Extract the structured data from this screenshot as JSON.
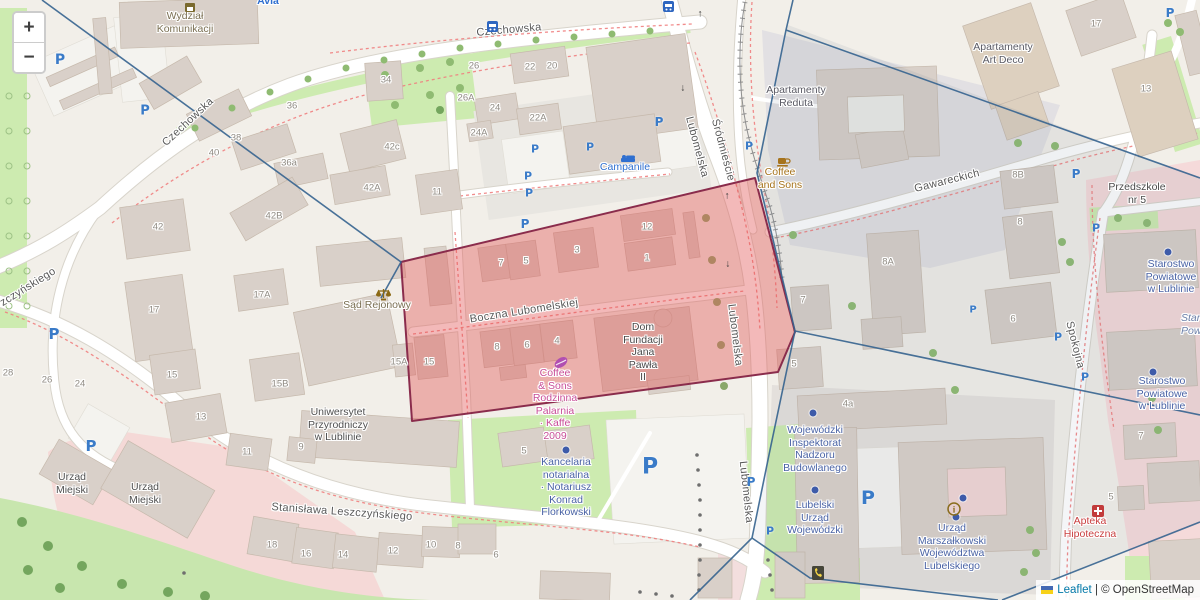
{
  "controls": {
    "zoom_in": "+",
    "zoom_out": "−"
  },
  "attribution": {
    "flag": "ukraine-flag-icon",
    "leaflet": "Leaflet",
    "separator": " | ",
    "osm": "© OpenStreetMap"
  },
  "colors": {
    "street": "#595959",
    "number": "#8f8a82",
    "place": "#5a5a64",
    "place_dark": "#4a4a4a",
    "gov": "#4a63a5",
    "amenity": "#7a6f52",
    "cafe": "#a6731c",
    "shop_pink": "#c84d97",
    "hotel_blue": "#2f6fd0",
    "pharmacy_red": "#c94040",
    "uni_gray": "#4f4f4f",
    "italic_blue": "#6b7fa8",
    "parking_blue": "#3a7bc8",
    "red_overlay_border": "#8a2c4c",
    "blue_boundary": "#35638f"
  },
  "labels": {
    "streets": [
      {
        "text": "Czechowska",
        "x": 188,
        "y": 122,
        "rot": -43
      },
      {
        "text": "Czechowska",
        "x": 509,
        "y": 30,
        "rot": -5
      },
      {
        "text": "Lubomelska",
        "x": 697,
        "y": 147,
        "rot": 75
      },
      {
        "text": "Śródmieście",
        "x": 723,
        "y": 150,
        "rot": 75
      },
      {
        "text": "Lubomelska",
        "x": 735,
        "y": 335,
        "rot": 83
      },
      {
        "text": "Lubomelska",
        "x": 746,
        "y": 492,
        "rot": 84
      },
      {
        "text": "Boczna Lubomelskiej",
        "x": 524,
        "y": 311,
        "rot": -9
      },
      {
        "text": "Stanisława Leszczyńskiego",
        "x": 342,
        "y": 512,
        "rot": 4
      },
      {
        "text": "zczyńskiego",
        "x": 28,
        "y": 287,
        "rot": -32
      },
      {
        "text": "Spokojna",
        "x": 1075,
        "y": 345,
        "rot": 76
      },
      {
        "text": "Gawareckich",
        "x": 947,
        "y": 181,
        "rot": -14
      }
    ],
    "house_numbers": [
      {
        "text": "34",
        "x": 386,
        "y": 80
      },
      {
        "text": "26",
        "x": 474,
        "y": 66
      },
      {
        "text": "22",
        "x": 530,
        "y": 67
      },
      {
        "text": "20",
        "x": 552,
        "y": 66
      },
      {
        "text": "26A",
        "x": 466,
        "y": 98
      },
      {
        "text": "24",
        "x": 495,
        "y": 108
      },
      {
        "text": "22A",
        "x": 538,
        "y": 118
      },
      {
        "text": "24A",
        "x": 479,
        "y": 133
      },
      {
        "text": "42c",
        "x": 392,
        "y": 147
      },
      {
        "text": "42A",
        "x": 372,
        "y": 188
      },
      {
        "text": "11",
        "x": 437,
        "y": 192
      },
      {
        "text": "36",
        "x": 292,
        "y": 106
      },
      {
        "text": "36a",
        "x": 289,
        "y": 163
      },
      {
        "text": "38",
        "x": 236,
        "y": 138
      },
      {
        "text": "40",
        "x": 214,
        "y": 153
      },
      {
        "text": "42",
        "x": 158,
        "y": 227
      },
      {
        "text": "42B",
        "x": 274,
        "y": 216
      },
      {
        "text": "17A",
        "x": 262,
        "y": 295
      },
      {
        "text": "17",
        "x": 154,
        "y": 310
      },
      {
        "text": "15",
        "x": 172,
        "y": 375
      },
      {
        "text": "13",
        "x": 201,
        "y": 417
      },
      {
        "text": "15B",
        "x": 280,
        "y": 384
      },
      {
        "text": "28",
        "x": 8,
        "y": 373
      },
      {
        "text": "26",
        "x": 47,
        "y": 380
      },
      {
        "text": "24",
        "x": 80,
        "y": 384
      },
      {
        "text": "15A",
        "x": 399,
        "y": 362
      },
      {
        "text": "15",
        "x": 429,
        "y": 362
      },
      {
        "text": "7",
        "x": 501,
        "y": 263
      },
      {
        "text": "5",
        "x": 526,
        "y": 261
      },
      {
        "text": "3",
        "x": 577,
        "y": 250
      },
      {
        "text": "12",
        "x": 647,
        "y": 227
      },
      {
        "text": "1",
        "x": 647,
        "y": 258
      },
      {
        "text": "8",
        "x": 497,
        "y": 347
      },
      {
        "text": "6",
        "x": 527,
        "y": 345
      },
      {
        "text": "4",
        "x": 557,
        "y": 341
      },
      {
        "text": "17",
        "x": 1096,
        "y": 24
      },
      {
        "text": "13",
        "x": 1146,
        "y": 89
      },
      {
        "text": "8B",
        "x": 1018,
        "y": 175
      },
      {
        "text": "8",
        "x": 1020,
        "y": 222
      },
      {
        "text": "8A",
        "x": 888,
        "y": 262
      },
      {
        "text": "7",
        "x": 803,
        "y": 300
      },
      {
        "text": "5",
        "x": 794,
        "y": 364
      },
      {
        "text": "6",
        "x": 1013,
        "y": 319
      },
      {
        "text": "4a",
        "x": 848,
        "y": 404
      },
      {
        "text": "11",
        "x": 247,
        "y": 452
      },
      {
        "text": "9",
        "x": 301,
        "y": 447
      },
      {
        "text": "5",
        "x": 524,
        "y": 451
      },
      {
        "text": "18",
        "x": 272,
        "y": 545
      },
      {
        "text": "16",
        "x": 306,
        "y": 554
      },
      {
        "text": "14",
        "x": 343,
        "y": 555
      },
      {
        "text": "12",
        "x": 393,
        "y": 551
      },
      {
        "text": "10",
        "x": 431,
        "y": 545
      },
      {
        "text": "8",
        "x": 458,
        "y": 546
      },
      {
        "text": "6",
        "x": 496,
        "y": 555
      },
      {
        "text": "7",
        "x": 1141,
        "y": 436
      },
      {
        "text": "5",
        "x": 1111,
        "y": 497
      }
    ],
    "pois": [
      {
        "lines": [
          "Wydział",
          "Komunikacji"
        ],
        "x": 185,
        "y": 16,
        "color": "amenity"
      },
      {
        "lines": [
          "Avia"
        ],
        "x": 268,
        "y": 1,
        "color": "hotel_blue",
        "bold": true
      },
      {
        "lines": [
          "Apartamenty",
          "Reduta"
        ],
        "x": 796,
        "y": 90,
        "color": "place"
      },
      {
        "lines": [
          "Apartamenty",
          "Art Deco"
        ],
        "x": 1003,
        "y": 47,
        "color": "place"
      },
      {
        "lines": [
          "Campanile"
        ],
        "x": 625,
        "y": 167,
        "color": "hotel_blue"
      },
      {
        "lines": [
          "Coffee",
          "and Sons"
        ],
        "x": 780,
        "y": 172,
        "color": "cafe"
      },
      {
        "lines": [
          "Przedszkole",
          "nr 5"
        ],
        "x": 1137,
        "y": 187,
        "color": "place_dark"
      },
      {
        "lines": [
          "Starostwo",
          "Powiatowe",
          "w Lublinie"
        ],
        "x": 1171,
        "y": 264,
        "color": "gov"
      },
      {
        "lines": [
          "Starostwo",
          "Powiatowe",
          "w Lublinie"
        ],
        "x": 1162,
        "y": 381,
        "color": "gov"
      },
      {
        "lines": [
          "Starostwo",
          "Powiatowe"
        ],
        "x": 1181,
        "y": 318,
        "color": "italic_blue",
        "italic": true,
        "align": "left"
      },
      {
        "lines": [
          "Sąd Rejonowy"
        ],
        "x": 377,
        "y": 305,
        "color": "amenity"
      },
      {
        "lines": [
          "Coffee",
          "& Sons",
          "Rodzinna",
          "Palarnia",
          "· Kaffe",
          "2009"
        ],
        "x": 555,
        "y": 373,
        "color": "shop_pink"
      },
      {
        "lines": [
          "Dom",
          "Fundacji",
          "Jana",
          "Pawła",
          "II"
        ],
        "x": 643,
        "y": 327,
        "color": "place_dark"
      },
      {
        "lines": [
          "Uniwersytet",
          "Przyrodniczy",
          "w Lublinie"
        ],
        "x": 338,
        "y": 412,
        "color": "uni_gray"
      },
      {
        "lines": [
          "Urząd",
          "Miejski"
        ],
        "x": 72,
        "y": 477,
        "color": "uni_gray"
      },
      {
        "lines": [
          "Urząd",
          "Miejski"
        ],
        "x": 145,
        "y": 487,
        "color": "uni_gray"
      },
      {
        "lines": [
          "Kancelaria",
          "notarialna",
          "· Notariusz",
          "Konrad",
          "Florkowski"
        ],
        "x": 566,
        "y": 462,
        "color": "gov"
      },
      {
        "lines": [
          "Wojewódzki",
          "Inspektorat",
          "Nadzoru",
          "Budowlanego"
        ],
        "x": 815,
        "y": 430,
        "color": "gov"
      },
      {
        "lines": [
          "Lubelski",
          "Urząd",
          "Wojewódzki"
        ],
        "x": 815,
        "y": 505,
        "color": "gov"
      },
      {
        "lines": [
          "Urząd",
          "Marszałkowski",
          "Województwa",
          "Lubelskiego"
        ],
        "x": 952,
        "y": 528,
        "color": "gov"
      },
      {
        "lines": [
          "Apteka",
          "Hipoteczna"
        ],
        "x": 1090,
        "y": 521,
        "color": "pharmacy_red"
      }
    ]
  },
  "icons": {
    "parking_glyph": "P",
    "parking": [
      {
        "x": 60,
        "y": 60,
        "s": 14
      },
      {
        "x": 145,
        "y": 111,
        "s": 13
      },
      {
        "x": 54,
        "y": 334,
        "s": 15
      },
      {
        "x": 91,
        "y": 446,
        "s": 15
      },
      {
        "x": 525,
        "y": 224,
        "s": 12
      },
      {
        "x": 535,
        "y": 149,
        "s": 11
      },
      {
        "x": 590,
        "y": 147,
        "s": 11
      },
      {
        "x": 528,
        "y": 176,
        "s": 11
      },
      {
        "x": 529,
        "y": 193,
        "s": 11
      },
      {
        "x": 659,
        "y": 122,
        "s": 12
      },
      {
        "x": 749,
        "y": 146,
        "s": 11
      },
      {
        "x": 650,
        "y": 467,
        "s": 22
      },
      {
        "x": 751,
        "y": 482,
        "s": 12
      },
      {
        "x": 770,
        "y": 531,
        "s": 11
      },
      {
        "x": 868,
        "y": 498,
        "s": 19
      },
      {
        "x": 973,
        "y": 310,
        "s": 10
      },
      {
        "x": 1076,
        "y": 174,
        "s": 12
      },
      {
        "x": 1096,
        "y": 228,
        "s": 11
      },
      {
        "x": 1058,
        "y": 337,
        "s": 11
      },
      {
        "x": 1085,
        "y": 377,
        "s": 11
      },
      {
        "x": 1170,
        "y": 13,
        "s": 12
      }
    ],
    "company_dots": [
      {
        "x": 566,
        "y": 450
      },
      {
        "x": 813,
        "y": 413
      },
      {
        "x": 815,
        "y": 490
      },
      {
        "x": 963,
        "y": 498
      },
      {
        "x": 956,
        "y": 517
      },
      {
        "x": 1168,
        "y": 252
      },
      {
        "x": 1153,
        "y": 372
      }
    ],
    "oneway_arrows": [
      {
        "x": 700,
        "y": 14,
        "rot": 0
      },
      {
        "x": 683,
        "y": 88,
        "rot": 180
      },
      {
        "x": 727,
        "y": 196,
        "rot": 0
      },
      {
        "x": 728,
        "y": 264,
        "rot": 180
      }
    ],
    "misc": [
      {
        "type": "townhall-icon",
        "x": 185,
        "y": 3
      },
      {
        "type": "bus-icon",
        "x": 487,
        "y": 21
      },
      {
        "type": "bus-icon",
        "x": 663,
        "y": 1
      },
      {
        "type": "bed-icon",
        "x": 621,
        "y": 154
      },
      {
        "type": "cup-icon",
        "x": 777,
        "y": 157
      },
      {
        "type": "scales-icon",
        "x": 376,
        "y": 288
      },
      {
        "type": "coffee-bean-icon",
        "x": 553,
        "y": 356
      },
      {
        "type": "info-icon",
        "x": 947,
        "y": 502
      },
      {
        "type": "phone-icon",
        "x": 812,
        "y": 566
      },
      {
        "type": "pharmacy-icon",
        "x": 1092,
        "y": 505
      }
    ]
  }
}
